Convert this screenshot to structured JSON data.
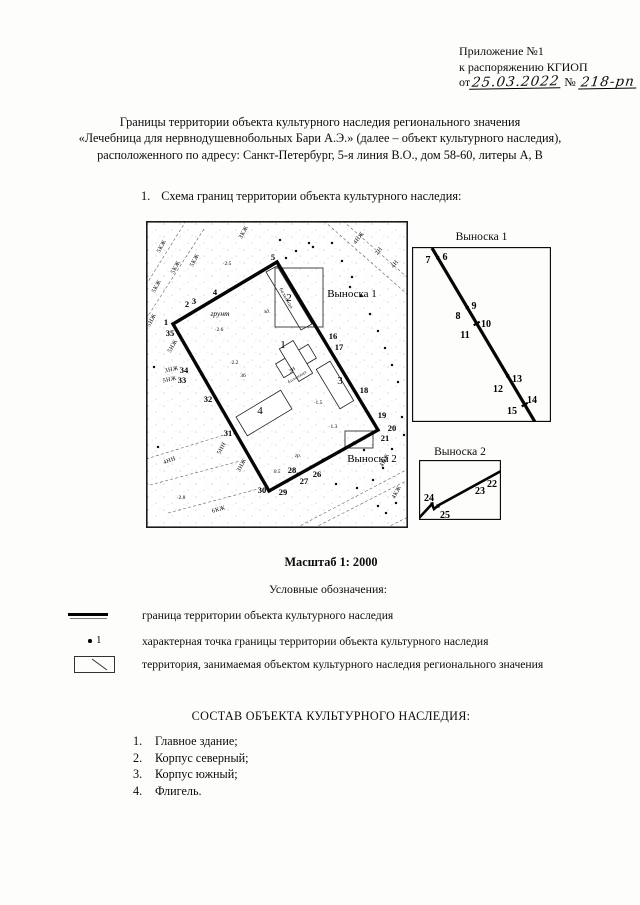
{
  "header": {
    "line1": "Приложение №1",
    "line2": "к распоряжению КГИОП",
    "date_prefix": "от",
    "date_value": "25.03.2022",
    "number_sign": "№",
    "number_value": "218-рп"
  },
  "title": {
    "line1": "Границы территории объекта культурного наследия регионального значения",
    "line2": "«Лечебница для нервнодушевнобольных Бари А.Э.» (далее – объект культурного наследия),",
    "line3": "расположенного по адресу: Санкт-Петербург, 5-я линия В.О., дом 58-60, литеры А, В"
  },
  "section1": {
    "number": "1.",
    "text": "Схема границ территории объекта культурного наследия:"
  },
  "scale_label": "Масштаб 1: 2000",
  "legend": {
    "heading": "Условные обозначения:",
    "items": [
      {
        "text": "граница территории объекта культурного наследия"
      },
      {
        "marker_number": "1",
        "text": "характерная точка границы территории объекта культурного наследия"
      },
      {
        "text": "территория, занимаемая объектом культурного наследия регионального значения"
      }
    ]
  },
  "composition": {
    "heading": "СОСТАВ ОБЪЕКТА КУЛЬТУРНОГО НАСЛЕДИЯ:",
    "items": [
      {
        "num": "1.",
        "text": "Главное здание;"
      },
      {
        "num": "2.",
        "text": "Корпус северный;"
      },
      {
        "num": "3.",
        "text": "Корпус южный;"
      },
      {
        "num": "4.",
        "text": "Флигель."
      }
    ]
  },
  "map": {
    "boundary": [
      [
        27,
        103
      ],
      [
        131,
        41
      ],
      [
        232,
        209
      ],
      [
        123,
        270
      ]
    ],
    "markers": [
      [
        27,
        103
      ],
      [
        131,
        41
      ],
      [
        232,
        209
      ],
      [
        123,
        270
      ],
      [
        44,
        93
      ],
      [
        50,
        89
      ],
      [
        70,
        77
      ],
      [
        141,
        58
      ],
      [
        147,
        68
      ],
      [
        152,
        76
      ],
      [
        158,
        86
      ],
      [
        178,
        119
      ],
      [
        184,
        129
      ],
      [
        210,
        172
      ],
      [
        222,
        192
      ],
      [
        218,
        217
      ],
      [
        208,
        222
      ],
      [
        193,
        231
      ],
      [
        177,
        239
      ],
      [
        165,
        246
      ],
      [
        152,
        253
      ],
      [
        141,
        260
      ],
      [
        89,
        212
      ],
      [
        70,
        178
      ],
      [
        60,
        160
      ],
      [
        52,
        146
      ],
      [
        34,
        115
      ]
    ],
    "dots": [
      [
        140,
        37
      ],
      [
        134,
        19
      ],
      [
        167,
        26
      ],
      [
        186,
        22
      ],
      [
        204,
        66
      ],
      [
        196,
        40
      ],
      [
        206,
        56
      ],
      [
        215,
        75
      ],
      [
        224,
        93
      ],
      [
        232,
        110
      ],
      [
        239,
        127
      ],
      [
        246,
        144
      ],
      [
        252,
        161
      ],
      [
        150,
        30
      ],
      [
        163,
        22
      ],
      [
        246,
        228
      ],
      [
        237,
        247
      ],
      [
        227,
        259
      ],
      [
        211,
        267
      ],
      [
        250,
        282
      ],
      [
        240,
        292
      ],
      [
        232,
        285
      ],
      [
        218,
        229
      ],
      [
        190,
        263
      ],
      [
        12,
        226
      ],
      [
        8,
        146
      ],
      [
        256,
        196
      ],
      [
        258,
        214
      ]
    ],
    "streets": [
      [
        178,
        0,
        262,
        74
      ],
      [
        197,
        0,
        262,
        57
      ],
      [
        0,
        98,
        58,
        8
      ],
      [
        0,
        64,
        40,
        0
      ],
      [
        0,
        238,
        78,
        214
      ],
      [
        4,
        264,
        94,
        240
      ],
      [
        22,
        292,
        112,
        268
      ],
      [
        150,
        307,
        262,
        248
      ],
      [
        168,
        307,
        262,
        259
      ],
      [
        240,
        307,
        262,
        296
      ]
    ],
    "buildings": [
      {
        "rect": [
          150,
          140,
          38,
          16,
          -31
        ]
      },
      {
        "rect": [
          150,
          140,
          16,
          38,
          -31
        ]
      },
      {
        "rect": [
          189,
          164,
          46,
          16,
          59
        ]
      },
      {
        "rect": [
          118,
          192,
          52,
          22,
          -31
        ]
      },
      {
        "poly": [
          [
            120,
            51
          ],
          [
            131,
            45
          ],
          [
            166,
            103
          ],
          [
            155,
            109
          ]
        ]
      }
    ],
    "inset_rects": [
      [
        129,
        47,
        48,
        59
      ],
      [
        199,
        210,
        28,
        17
      ]
    ],
    "point_labels": [
      {
        "t": "1",
        "x": 20,
        "y": 104
      },
      {
        "t": "2",
        "x": 41,
        "y": 86
      },
      {
        "t": "3",
        "x": 48,
        "y": 83
      },
      {
        "t": "4",
        "x": 69,
        "y": 74
      },
      {
        "t": "5",
        "x": 127,
        "y": 39
      },
      {
        "t": "16",
        "x": 187,
        "y": 118
      },
      {
        "t": "17",
        "x": 193,
        "y": 129
      },
      {
        "t": "18",
        "x": 218,
        "y": 172
      },
      {
        "t": "19",
        "x": 236,
        "y": 197
      },
      {
        "t": "20",
        "x": 246,
        "y": 210
      },
      {
        "t": "21",
        "x": 239,
        "y": 220
      },
      {
        "t": "26",
        "x": 171,
        "y": 256
      },
      {
        "t": "27",
        "x": 158,
        "y": 263
      },
      {
        "t": "28",
        "x": 146,
        "y": 252
      },
      {
        "t": "29",
        "x": 137,
        "y": 274
      },
      {
        "t": "30",
        "x": 116,
        "y": 272
      },
      {
        "t": "31",
        "x": 82,
        "y": 215
      },
      {
        "t": "32",
        "x": 62,
        "y": 181
      },
      {
        "t": "33",
        "x": 36,
        "y": 162
      },
      {
        "t": "34",
        "x": 38,
        "y": 152
      },
      {
        "t": "35",
        "x": 24,
        "y": 115
      }
    ],
    "building_labels": [
      {
        "t": "1",
        "x": 137,
        "y": 127
      },
      {
        "t": "2",
        "x": 143,
        "y": 80
      },
      {
        "t": "3",
        "x": 194,
        "y": 163
      },
      {
        "t": "4",
        "x": 114,
        "y": 193
      }
    ],
    "callout_labels": [
      {
        "t": "Выноска 1",
        "x": 206,
        "y": 76
      },
      {
        "t": "Выноска 2",
        "x": 226,
        "y": 241
      }
    ],
    "area_labels": [
      {
        "t": "5КЖ",
        "x": 17,
        "y": 26,
        "r": -62
      },
      {
        "t": "5КЖ",
        "x": 31,
        "y": 47,
        "r": -62
      },
      {
        "t": "5КЖ",
        "x": 50,
        "y": 40,
        "r": -62
      },
      {
        "t": "5КЖ",
        "x": 12,
        "y": 66,
        "r": -62
      },
      {
        "t": "ЗКЖ",
        "x": 99,
        "y": 12,
        "r": -62
      },
      {
        "t": "5НЖ",
        "x": 7,
        "y": 100,
        "r": -62
      },
      {
        "t": "5НЖ",
        "x": 28,
        "y": 126,
        "r": -60
      },
      {
        "t": "ЗНЖ",
        "x": 26,
        "y": 150,
        "r": -12
      },
      {
        "t": "5НЖ",
        "x": 24,
        "y": 160,
        "r": -12
      },
      {
        "t": "5НН",
        "x": 77,
        "y": 228,
        "r": -62
      },
      {
        "t": "ЗНЖ",
        "x": 97,
        "y": 245,
        "r": -62
      },
      {
        "t": "6КЖ",
        "x": 73,
        "y": 290,
        "r": -16
      },
      {
        "t": "4НН",
        "x": 24,
        "y": 241,
        "r": -20
      },
      {
        "t": "4НЖ",
        "x": 214,
        "y": 18,
        "r": -52
      },
      {
        "t": "2Н",
        "x": 234,
        "y": 31,
        "r": -52
      },
      {
        "t": "4Н",
        "x": 250,
        "y": 44,
        "r": -52
      },
      {
        "t": "4НЖ",
        "x": 240,
        "y": 240,
        "r": -62
      },
      {
        "t": "4КЖ",
        "x": 252,
        "y": 272,
        "r": -62
      },
      {
        "t": "больница",
        "x": 139,
        "y": 78,
        "r": 60,
        "s": 5
      },
      {
        "t": "3Н",
        "x": 147,
        "y": 150,
        "r": -31,
        "s": 5
      },
      {
        "t": "больница",
        "x": 152,
        "y": 157,
        "r": -31,
        "s": 4.5
      }
    ],
    "micro_labels": [
      {
        "t": "·2.5",
        "x": 81,
        "y": 44
      },
      {
        "t": "·2.6",
        "x": 73,
        "y": 110
      },
      {
        "t": "·2.2",
        "x": 88,
        "y": 143
      },
      {
        "t": "36",
        "x": 97,
        "y": 156
      },
      {
        "t": "·1.3",
        "x": 187,
        "y": 207
      },
      {
        "t": "0.5",
        "x": 131,
        "y": 252,
        "i": 1
      },
      {
        "t": "гр.",
        "x": 152,
        "y": 236,
        "i": 1
      },
      {
        "t": "зд.",
        "x": 121,
        "y": 92,
        "i": 1
      },
      {
        "t": "·2.8",
        "x": 35,
        "y": 278
      },
      {
        "t": "·1.5",
        "x": 172,
        "y": 183
      },
      {
        "t": "грунт",
        "x": 74,
        "y": 95,
        "i": 1,
        "s": 7.5
      }
    ]
  },
  "inset1": {
    "title": "Выноска 1",
    "box": [
      139,
      175
    ],
    "line": [
      [
        20,
        1
      ],
      [
        123,
        175
      ]
    ],
    "squares": [
      [
        25.7,
        10.6
      ],
      [
        55.3,
        60.6
      ],
      [
        95.7,
        128.9
      ]
    ],
    "ticks": [
      [
        61.7,
        78.3,
        67.7,
        74.7
      ],
      [
        109.7,
        159.4,
        115.7,
        155.8
      ]
    ],
    "labels": [
      {
        "t": "6",
        "x": 33,
        "y": 13
      },
      {
        "t": "7",
        "x": 16,
        "y": 16
      },
      {
        "t": "8",
        "x": 46,
        "y": 72
      },
      {
        "t": "9",
        "x": 62,
        "y": 62
      },
      {
        "t": "10",
        "x": 74,
        "y": 80
      },
      {
        "t": "11",
        "x": 53,
        "y": 91
      },
      {
        "t": "12",
        "x": 86,
        "y": 145
      },
      {
        "t": "13",
        "x": 105,
        "y": 135
      },
      {
        "t": "14",
        "x": 120,
        "y": 156
      },
      {
        "t": "15",
        "x": 100,
        "y": 167
      }
    ]
  },
  "inset2": {
    "title": "Выноска 2",
    "box": [
      82,
      60
    ],
    "polyline": [
      [
        0,
        58
      ],
      [
        13,
        44
      ],
      [
        15,
        49
      ],
      [
        20,
        45
      ],
      [
        82,
        11
      ]
    ],
    "squares": [
      [
        13,
        44
      ],
      [
        19,
        46
      ]
    ],
    "ticks": [],
    "labels": [
      {
        "t": "22",
        "x": 73,
        "y": 27
      },
      {
        "t": "23",
        "x": 61,
        "y": 34
      },
      {
        "t": "24",
        "x": 10,
        "y": 41
      },
      {
        "t": "25",
        "x": 26,
        "y": 58
      }
    ]
  }
}
